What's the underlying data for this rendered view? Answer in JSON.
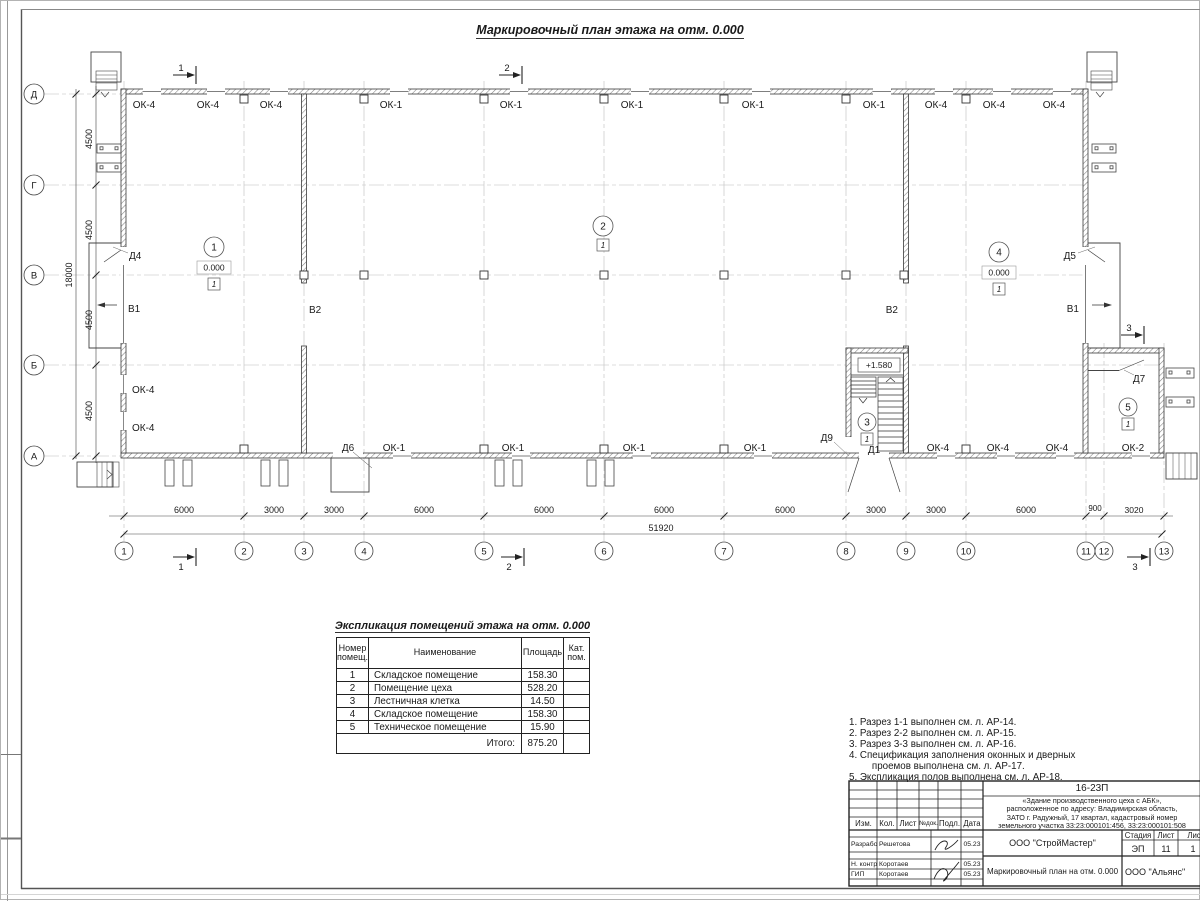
{
  "sheet": {
    "drawing_title": "Маркировочный план этажа на отм. 0.000"
  },
  "plan": {
    "axes_vertical": [
      "1",
      "2",
      "3",
      "4",
      "5",
      "6",
      "7",
      "8",
      "9",
      "10",
      "11",
      "12",
      "13"
    ],
    "axes_horizontal": [
      "Д",
      "Г",
      "В",
      "Б",
      "А"
    ],
    "dims_left": [
      "4500",
      "4500",
      "4500",
      "4500"
    ],
    "dim_left_total": "18000",
    "dims_bottom": [
      "6000",
      "3000",
      "3000",
      "6000",
      "6000",
      "6000",
      "6000",
      "3000",
      "3000",
      "6000",
      "900",
      "3020"
    ],
    "dim_bottom_total": "51920",
    "windows_top": [
      "ОК-4",
      "ОК-4",
      "ОК-4",
      "ОК-1",
      "ОК-1",
      "ОК-1",
      "ОК-1",
      "ОК-1",
      "ОК-4",
      "ОК-4",
      "ОК-4"
    ],
    "windows_bottom": [
      "ОК-1",
      "ОК-1",
      "ОК-1",
      "ОК-1",
      "ОК-4",
      "ОК-4",
      "ОК-4",
      "ОК-2"
    ],
    "windows_left": [
      "ОК-4",
      "ОК-4"
    ],
    "doors": {
      "d4": "Д4",
      "d5": "Д5",
      "d6": "Д6",
      "d7": "Д7",
      "d9": "Д9",
      "d1": "Д1"
    },
    "gates": {
      "left": "В1",
      "right": "В1",
      "internal_left": "В2",
      "internal_right": "В2"
    },
    "rooms": [
      {
        "num": "1",
        "elevation": "0.000",
        "floor": "1"
      },
      {
        "num": "2",
        "floor": "1"
      },
      {
        "num": "3",
        "floor": "1"
      },
      {
        "num": "4",
        "elevation": "0.000",
        "floor": "1"
      },
      {
        "num": "5",
        "floor": "1"
      }
    ],
    "stair_elevation": "+1.580",
    "sections": {
      "s1": "1",
      "s2": "2",
      "s3": "3"
    }
  },
  "table": {
    "title": "Экспликация помещений этажа на отм. 0.000",
    "headers": {
      "num": "Номер\nпомещ.",
      "name": "Наименование",
      "area": "Площадь",
      "cat": "Кат.\nпом."
    },
    "rows": [
      {
        "num": "1",
        "name": "Складское помещение",
        "area": "158.30"
      },
      {
        "num": "2",
        "name": "Помещение цеха",
        "area": "528.20"
      },
      {
        "num": "3",
        "name": "Лестничная клетка",
        "area": "14.50"
      },
      {
        "num": "4",
        "name": "Складское помещение",
        "area": "158.30"
      },
      {
        "num": "5",
        "name": "Техническое помещение",
        "area": "15.90"
      }
    ],
    "total_label": "Итого:",
    "total_value": "875.20"
  },
  "notes": [
    "1. Разрез 1-1 выполнен см. л. АР-14.",
    "2. Разрез 2-2 выполнен см. л. АР-15.",
    "3. Разрез 3-3 выполнен см. л. АР-16.",
    "4. Спецификация заполнения оконных и дверных\n    проемов выполнена см. л. АР-17.",
    "5. Экспликация полов выполнена см. л. АР-18."
  ],
  "titleblock": {
    "code": "16-23П",
    "description": "«Здание производственного цеха с АБК»,\nрасположенное по адресу: Владимирская область,\nЗАТО г. Радужный, 17 квартал, кадастровый номер\nземельного участка 33:23:000101:456, 33:23:000101:508",
    "headers": {
      "izm": "Изм.",
      "kol": "Кол.",
      "list": "Лист",
      "ndok": "№док.",
      "podl": "Подл.",
      "data": "Дата"
    },
    "rows": [
      {
        "role": "Разработал",
        "name": "Решетова",
        "date": "05.23"
      },
      {
        "role": "Н. контр.",
        "name": "Коротаев",
        "date": "05.23"
      },
      {
        "role": "ГИП",
        "name": "Коротаев",
        "date": "05.23"
      }
    ],
    "company": "ООО \"СтройМастер\"",
    "stage_label": "Стадия",
    "sheet_label": "Лист",
    "sheets_label": "Листов",
    "stage": "ЭП",
    "sheet_num": "11",
    "sheets_num": "1",
    "doc_title": "Маркировочный план на отм. 0.000",
    "customer": "ООО \"Альянс\""
  }
}
